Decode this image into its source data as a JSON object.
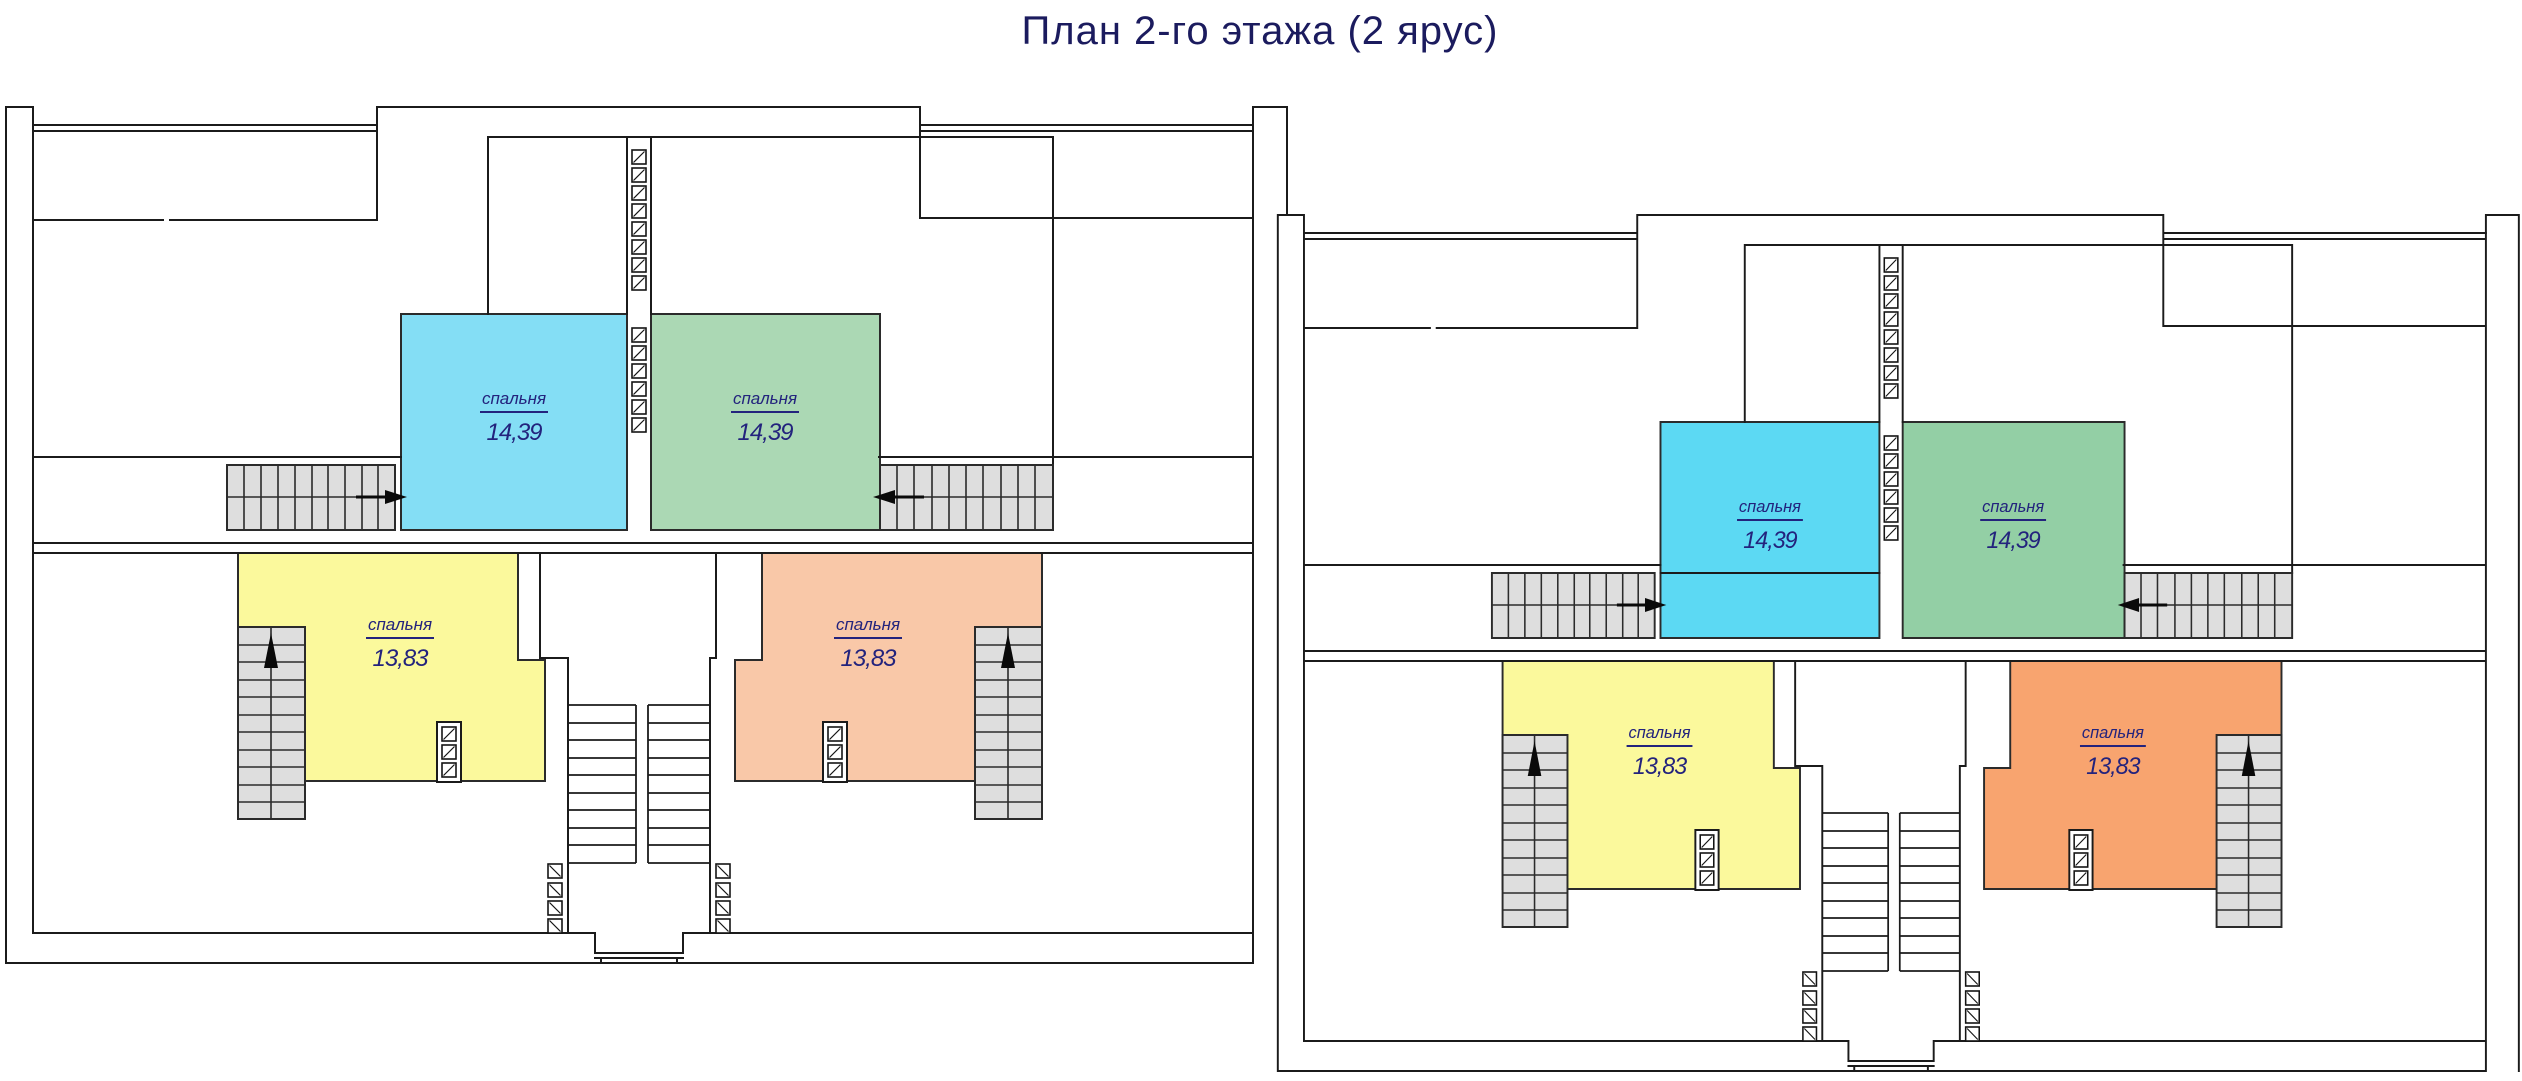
{
  "title": "План 2-го этажа (2 ярус)",
  "title_color": "#1b1b5e",
  "label_color": "#23237d",
  "wall_color": "#1b1b1b",
  "stair_fill": "#dedede",
  "symbols": {
    "vent_block_icon": "hatched-square",
    "stair_direction_icon": "black-arrow"
  },
  "units": [
    {
      "name": "left-block",
      "rooms": [
        {
          "id": "bedroom-blue",
          "name": "спальня",
          "area": "14,39",
          "color": "#84DEF5"
        },
        {
          "id": "bedroom-green",
          "name": "спальня",
          "area": "14,39",
          "color": "#ABD8B4"
        },
        {
          "id": "bedroom-yellow",
          "name": "спальня",
          "area": "13,83",
          "color": "#FBF99C"
        },
        {
          "id": "bedroom-salmon",
          "name": "спальня",
          "area": "13,83",
          "color": "#F9C8A8"
        }
      ]
    },
    {
      "name": "right-block",
      "rooms": [
        {
          "id": "bedroom-blue",
          "name": "спальня",
          "area": "14,39",
          "color": "#5CD9F3"
        },
        {
          "id": "bedroom-green",
          "name": "спальня",
          "area": "14,39",
          "color": "#93CFA5"
        },
        {
          "id": "bedroom-yellow",
          "name": "спальня",
          "area": "13,83",
          "color": "#FBF99C"
        },
        {
          "id": "bedroom-orange",
          "name": "спальня",
          "area": "13,83",
          "color": "#F8A46F"
        }
      ]
    }
  ]
}
